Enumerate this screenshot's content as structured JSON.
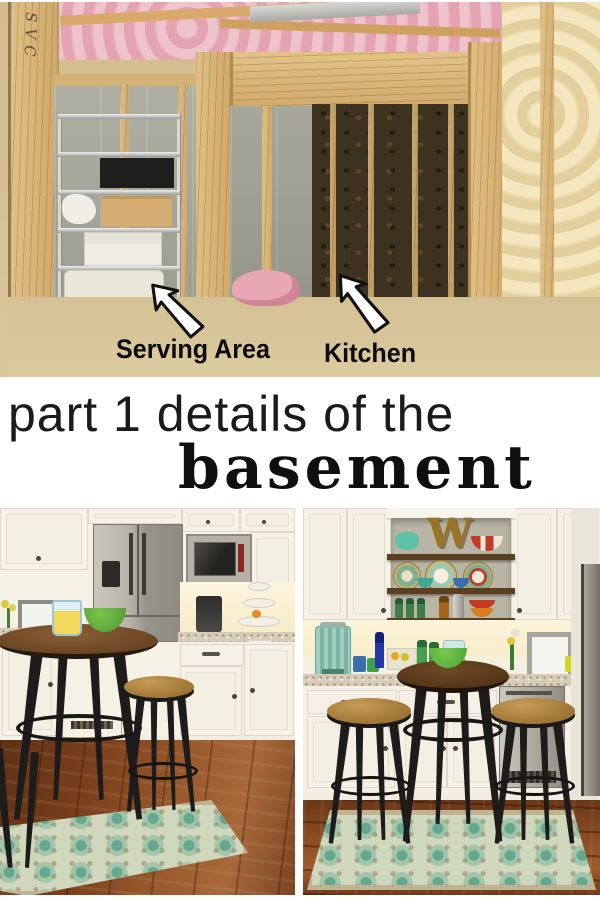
{
  "collage": {
    "background": "#ffffff",
    "title": {
      "line1": "part 1 details of the",
      "line2": "basement",
      "color": "#141414"
    },
    "top_photo": {
      "name": "unfinished-basement-before",
      "labels": {
        "serving_area": "Serving Area",
        "kitchen": "Kitchen"
      },
      "stud_writing": "SVC",
      "arrow_style": {
        "fill": "#ffffff",
        "stroke": "#111111"
      },
      "palette": {
        "stud_wood": "#dcb97e",
        "pink_insulation": "#e9afbb",
        "dark_insulation": "#3d3120",
        "cream_insulation": "#ecd9ab",
        "concrete_wall": "#a5a49a",
        "floor": "#d8c59b"
      }
    },
    "bottom_left_photo": {
      "name": "finished-kitchen-after",
      "items": [
        "upper-cabinets",
        "stainless-refrigerator",
        "built-in-microwave",
        "coffee-maker",
        "tiered-stand",
        "dish-towel",
        "granite-counter",
        "lower-cabinets",
        "dishwasher",
        "picture-frame",
        "flowers",
        "lemonade-pitcher",
        "green-bowl",
        "pub-table",
        "metal-stool",
        "teal-rug",
        "wood-floor"
      ],
      "palette": {
        "cabinets": "#f4f0e5",
        "stainless": "#b3afa4",
        "floor": "#7c4320",
        "rug_teal": "#74ab96",
        "table_wood": "#7a5330"
      }
    },
    "bottom_right_photo": {
      "name": "finished-serving-area-after",
      "shelf_letter": "W",
      "items": [
        "open-shelves",
        "teal-teapot",
        "decorative-plates",
        "green-bottles",
        "amber-bottle",
        "cocktail-shaker",
        "red-bowls",
        "beverage-dispenser",
        "blue-bottle",
        "citrus-tray",
        "flowers",
        "picture-frame",
        "granite-counter",
        "beverage-fridge",
        "pub-table",
        "green-bowl",
        "metal-stools",
        "teal-rug",
        "wood-floor",
        "hall-refrigerator"
      ],
      "palette": {
        "niche_wall": "#b9b5a4",
        "shelf_wood": "#5a4020",
        "letter_gold": "#9a7426"
      }
    }
  }
}
